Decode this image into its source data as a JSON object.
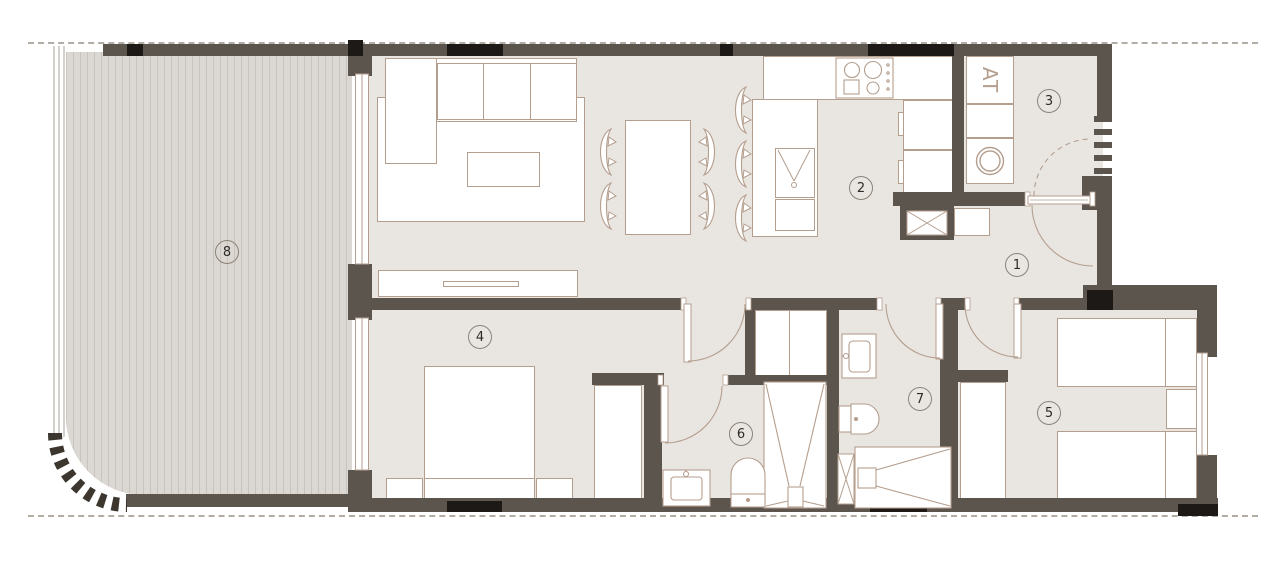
{
  "plan": {
    "rooms": [
      {
        "label": "1"
      },
      {
        "label": "2"
      },
      {
        "label": "3"
      },
      {
        "label": "4"
      },
      {
        "label": "5"
      },
      {
        "label": "6"
      },
      {
        "label": "7"
      },
      {
        "label": "8"
      }
    ],
    "utility_unit_label": "AT",
    "colors": {
      "wall": "#5c554d",
      "column": "#1d1916",
      "floor": "#e9e6e2",
      "deck": "#dbd7d2",
      "furniture_line": "#b49e8e",
      "boundary_dash": "#b3aca4"
    }
  }
}
